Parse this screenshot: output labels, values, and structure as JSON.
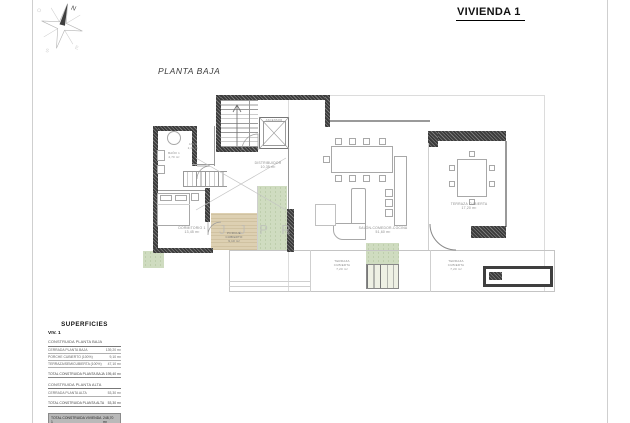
{
  "header": {
    "vivienda": "VIVIENDA 1"
  },
  "plan_title": "PLANTA BAJA",
  "watermark": {
    "text": "J J  P R"
  },
  "compass": {
    "n": "N",
    "s": "S",
    "e": "E",
    "o": "O"
  },
  "plan": {
    "rooms": {
      "ascensor": {
        "name": "ASCENSOR"
      },
      "aseo": {
        "name": "ASEO",
        "area": "2,40 m²"
      },
      "bano": {
        "name": "BAÑO 1",
        "area": "4,70 m²"
      },
      "distribuidor": {
        "name": "DISTRIBUIDOR",
        "area": "10,35 m²"
      },
      "dormitorio1": {
        "name": "DORMITORIO 1",
        "area": "13,45 m²"
      },
      "porche": {
        "name": "PORCHE CUBIERTO",
        "area": "9,10 m²"
      },
      "salon": {
        "name": "SALÓN-COMEDOR-COCINA",
        "area": "51,60 m²"
      },
      "terraza_grande": {
        "name": "TERRAZA CUBIERTA",
        "area": "17,20 m²"
      },
      "terraza_1": {
        "name": "TERRAZA CUBIERTA",
        "area": "7,20 m²"
      },
      "terraza_2": {
        "name": "TERRAZA CUBIERTA",
        "area": "7,20 m²"
      }
    }
  },
  "superficies": {
    "title": "SUPERFICIES",
    "subtitle": "VIV. 1",
    "section1": {
      "header": "CONSTRUIDA PLANTA BAJA",
      "rows": [
        {
          "label": "CERRADA PLANTA BAJA",
          "value": "139,20 m²"
        },
        {
          "label": "PORCHE CUBIERTO (100%)",
          "value": "9,10 m²"
        },
        {
          "label": "TERRAZA/SEMICUBIERTA (100%)",
          "value": "47,10 m²"
        }
      ],
      "total_label": "TOTAL CONSTRUIDA PLANTA BAJA",
      "total_value": "195,40 m²"
    },
    "section2": {
      "header": "CONSTRUIDA PLANTA ALTA",
      "rows": [
        {
          "label": "CERRADA PLANTA ALTA",
          "value": "53,30 m²"
        }
      ],
      "total_label": "TOTAL CONSTRUIDA PLANTA ALTA",
      "total_value": "53,30 m²"
    },
    "grand_total_label": "TOTAL CONSTRUIDA VIVIENDA 1",
    "grand_total_value": "248,70 m²"
  },
  "colors": {
    "wall": "#3b3b3b",
    "vegetation": "#cfdcc0",
    "wood_deck": "#ddd0b2",
    "grand_total_bg": "#b9b9b9"
  }
}
